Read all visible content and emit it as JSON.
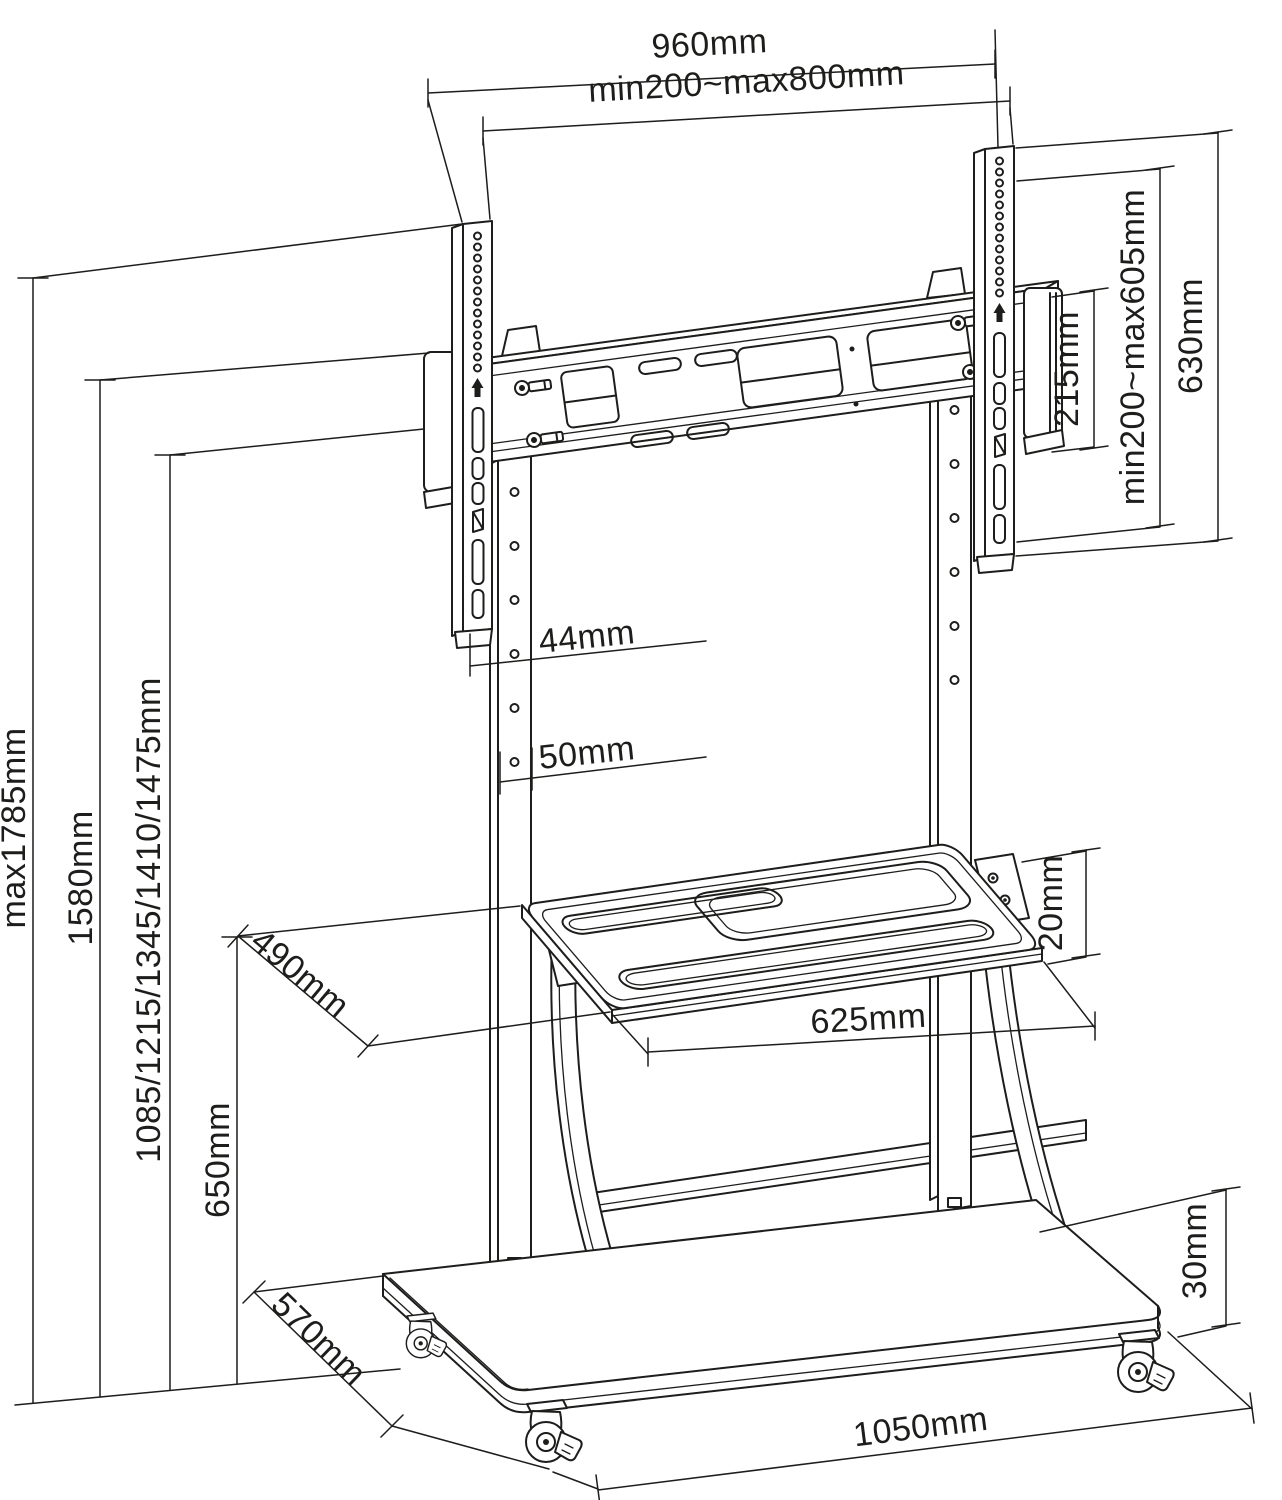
{
  "drawing": {
    "subject": "Mobile TV floor stand with mounting rail, VESA brackets, shelf and caster base - dimensional line drawing",
    "colors": {
      "line": "#1d1d1b",
      "background": "#ffffff"
    }
  },
  "dimensions": {
    "top": {
      "overall_width": "960mm",
      "vesa_width_range": "min200~max800mm"
    },
    "right": {
      "end_bracket_height": "215mm",
      "vesa_height_range": "min200~max605mm",
      "bracket_height": "630mm"
    },
    "left": {
      "max_height": "max1785mm",
      "frame_height": "1580mm",
      "display_center_heights": "1085/1215/1345/1410/1475mm",
      "shelf_height": "650mm"
    },
    "column": {
      "width": "44mm",
      "depth": "50mm"
    },
    "shelf": {
      "depth": "490mm",
      "thickness": "20mm",
      "width": "625mm"
    },
    "base": {
      "depth": "570mm",
      "thickness": "30mm",
      "width": "1050mm"
    }
  }
}
